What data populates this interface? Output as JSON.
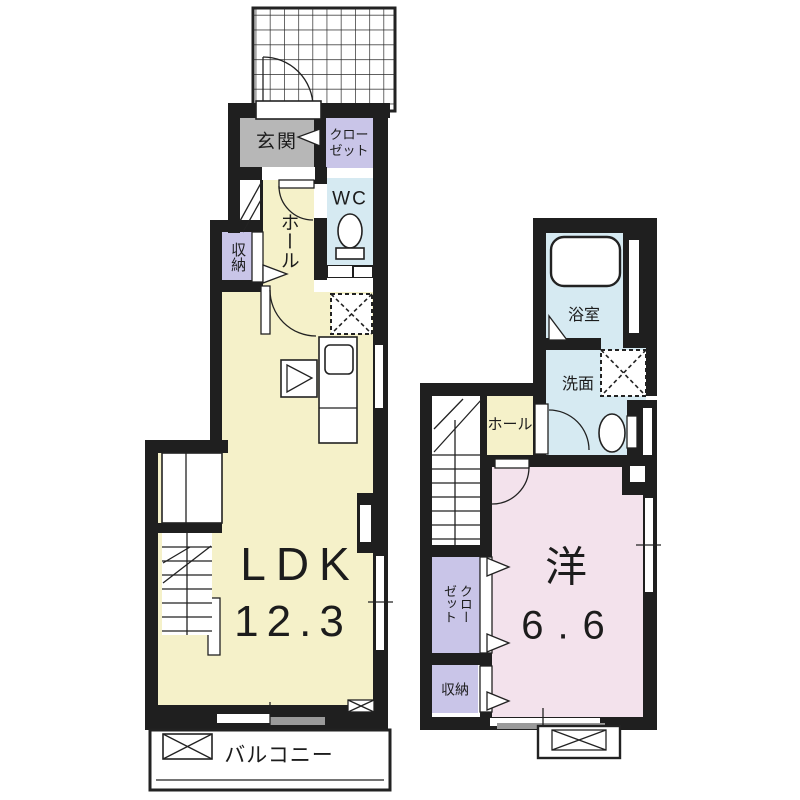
{
  "plan": {
    "type": "floor-plan",
    "floors": [
      "1F",
      "2F"
    ]
  },
  "floor1": {
    "genkan": "玄関",
    "closet": "クローゼット",
    "closet_line1": "クロー",
    "closet_line2": "ゼット",
    "hall": "ホール",
    "wc": "WC",
    "storage": "収納",
    "ldk": "LDK",
    "ldk_size": "12.3",
    "balcony": "バルコニー"
  },
  "floor2": {
    "bathroom": "浴室",
    "washroom": "洗面",
    "hall": "ホール",
    "closet": "クローゼット",
    "closet_line1": "クロー",
    "closet_line2": "ゼット",
    "storage": "収納",
    "room": "洋",
    "room_size": "6.6"
  },
  "colors": {
    "wall": "#1f1f1f",
    "outline": "#222222",
    "text": "#1c1c1c",
    "room_yellow": "#f5f1c9",
    "room_blue": "#d6eaf2",
    "room_pink": "#f3e2ec",
    "room_lavender": "#c9c5e8",
    "room_gray": "#b7b7b7",
    "window_gray": "#9a9a9a"
  }
}
